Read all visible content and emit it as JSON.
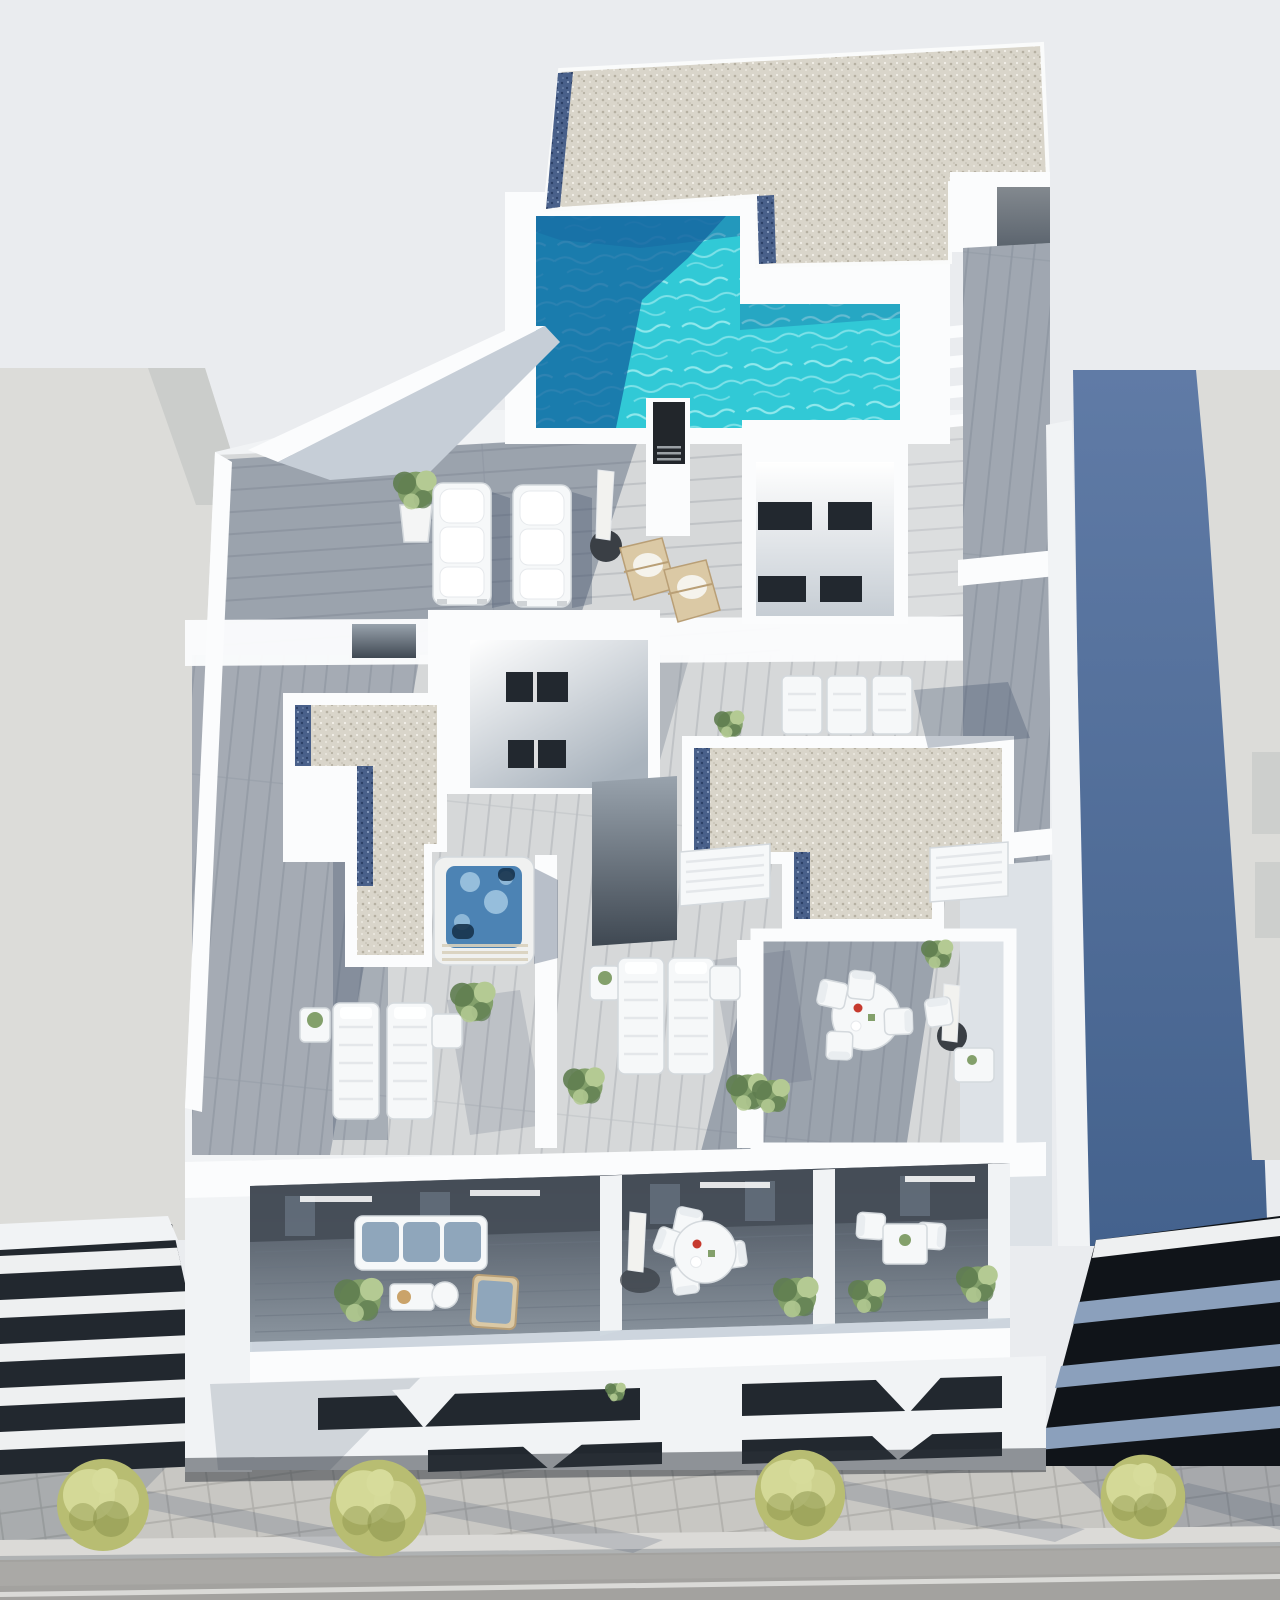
{
  "meta": {
    "type": "3d-architectural-render",
    "view": "aerial-axonometric",
    "subject": "Rooftop terraces of a modern white apartment building with an L-shaped turquoise pool, gravel roofs, hot tub, sun loungers, furnished balconies and a street with trees below"
  },
  "objects": {
    "rooftop_pool": "L-shaped turquoise swimming pool",
    "hot_tub": "square hot tub on middle terrace",
    "padded_sun_loungers": 2,
    "slatted_sun_loungers": 7,
    "wooden_deck_chairs": 2,
    "closed_parasols": 3,
    "dining_sets": 3,
    "balcony_sofa_sets": 1,
    "gravel_roof_sections": 3,
    "lightwell_courtyards": 2,
    "street_trees": 4,
    "potted_plants": 14,
    "roof_stairs": 1
  },
  "colors": {
    "sky": "#eaecef",
    "wall_white": "#fbfcfd",
    "wall_light": "#f1f3f5",
    "wall_shade": "#dde2e7",
    "wall_dark": "#c6ced7",
    "gravel_base": "#d9d5ca",
    "gravel_dot": "#b5b0a2",
    "gravel_speck": "#f7f5ef",
    "bgravel_base": "#49608a",
    "bgravel_dot": "#2c4066",
    "bgravel_speck": "#93a7c8",
    "pool_water": "#31c9d6",
    "pool_ripple": "#aff2f3",
    "pool_shadow": "#1567a1",
    "deck_light": "#d6d8d9",
    "deck_line": "#bcc0c3",
    "shadow": "#3d4d66",
    "tub_shell": "#f0f1f0",
    "tub_base": "#d8d0bc",
    "tub_water": "#4c83b4",
    "tub_foam": "#a9cde6",
    "tub_seat": "#17334c",
    "blue_wall_top": "#607ba6",
    "blue_wall_bot": "#44628d",
    "nb_light": "#dcdcd9",
    "nb_facet": "#cbcdcb",
    "band_dark": "#22282f",
    "band_dark2": "#101419",
    "band_white": "#eef0f1",
    "band_slab": "#8ba0bc",
    "balc_wall": "#454d57",
    "balc_mid": "#5e6772",
    "balc_floor": "#8b959f",
    "balc_glass": "#b9c6d2",
    "cushion": "#8fa6bb",
    "furn_white": "#f6f8f9",
    "wood_furn": "#dbc9a5",
    "parasol_white": "#f2f2ef",
    "parasol_base": "#3a3f45",
    "plant_dark": "#5f7d50",
    "plant_mid": "#83a06b",
    "plant_light": "#b4ca93",
    "pot_white": "#f4f5f5",
    "sidewalk": "#c8c7c3",
    "sidewalk_line": "#aeada9",
    "curb": "#dbdad7",
    "road": "#a3a29f",
    "road_light": "#b0afac",
    "road_mark": "#e4e4e0",
    "tree_light": "#d7dc9b",
    "tree_mid": "#b8bd72",
    "tree_dark": "#868f47",
    "chimney": "#22262b",
    "chimney_slat": "#9aa0a5",
    "door_dark": "#5a636d",
    "slot_top": "#99a3ad",
    "slot_bot": "#3f4852",
    "sk_floor": "#a9b3bd",
    "lw_floor": "#c6cdd4"
  }
}
